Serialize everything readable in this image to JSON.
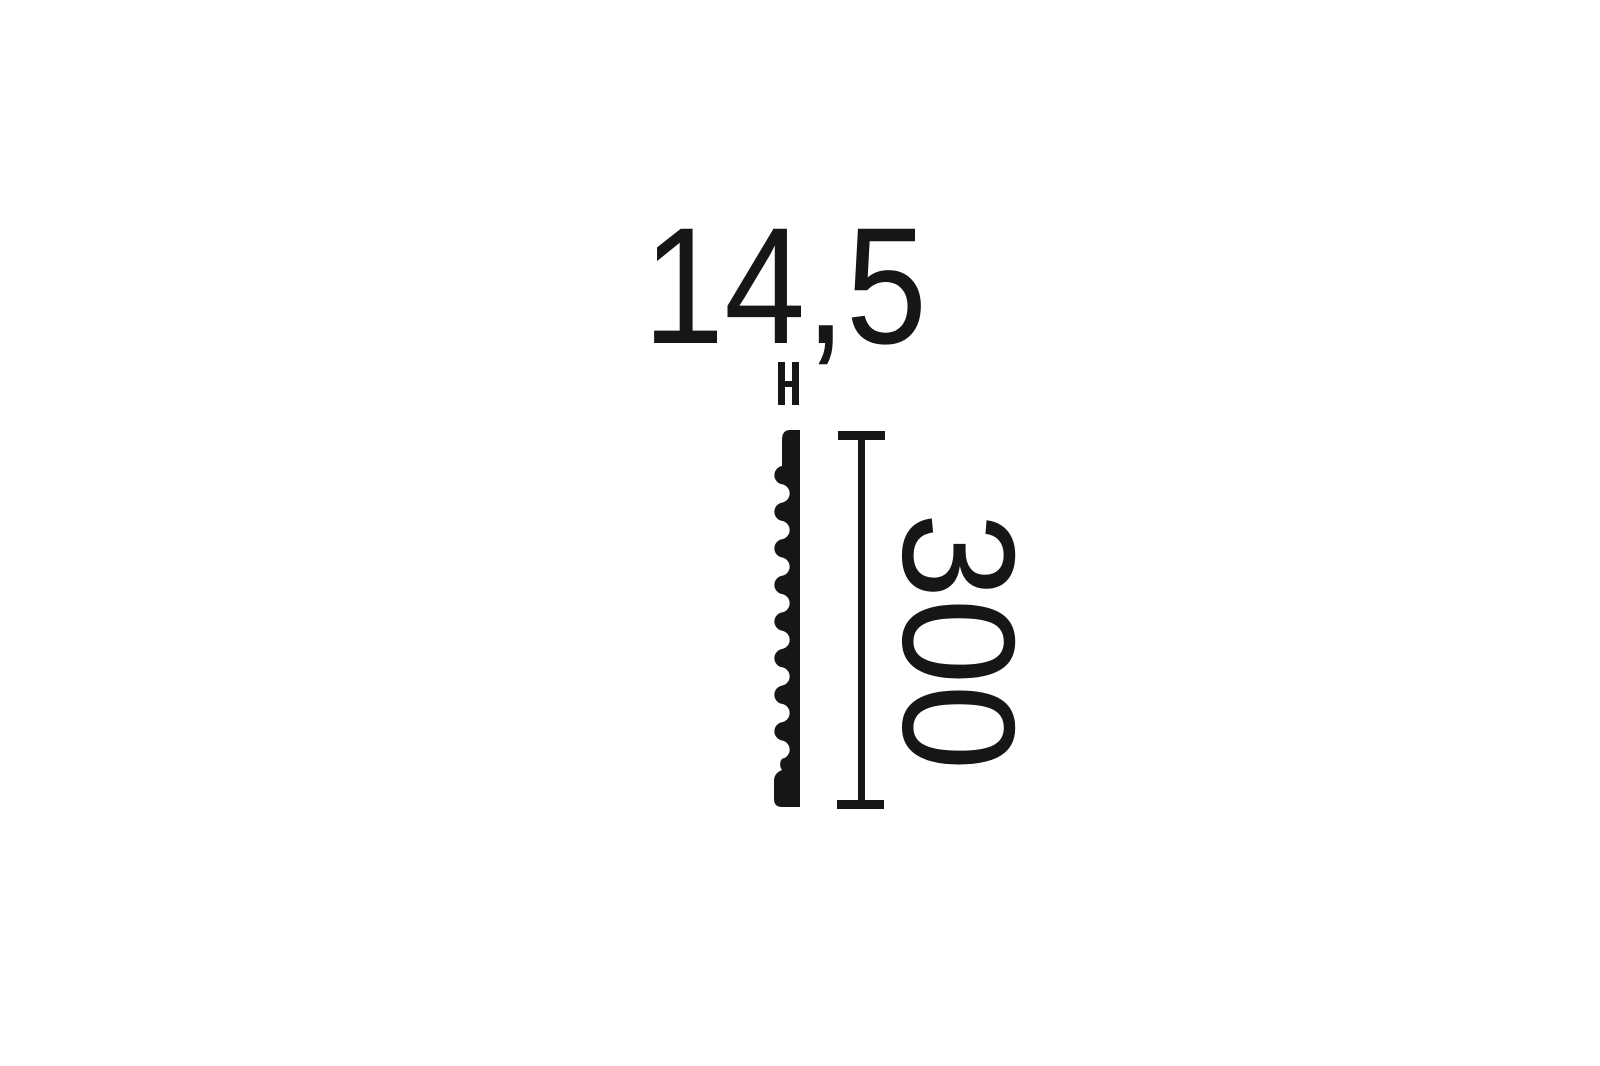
{
  "diagram": {
    "background_color": "#ffffff",
    "ink_color": "#161616",
    "width_dimension": {
      "label": "14,5",
      "marker_icon": "width-extent-ticks-icon"
    },
    "height_dimension": {
      "label": "300",
      "marker_icon": "t-bar-dimension-line-icon"
    },
    "subject": "moulding-profile-cross-section"
  }
}
